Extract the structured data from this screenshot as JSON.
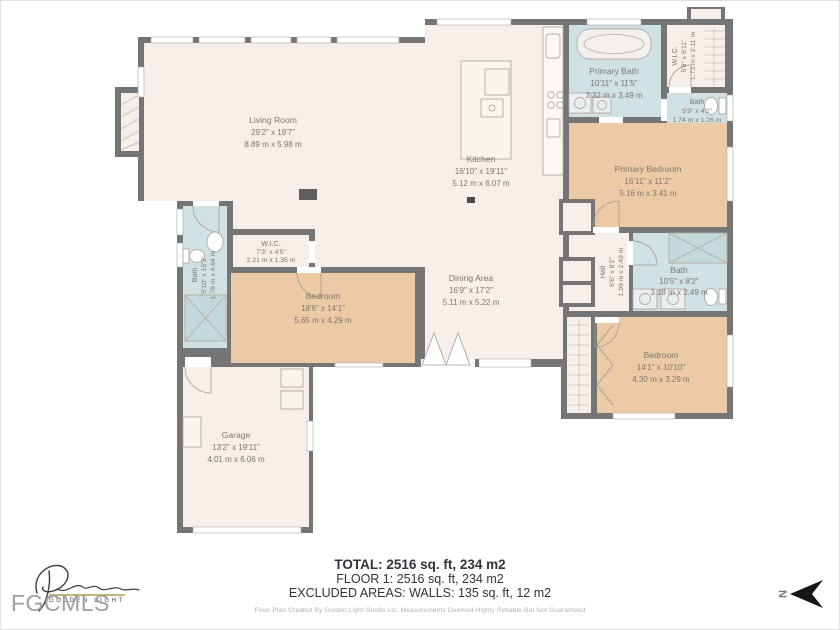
{
  "plan": {
    "rooms": {
      "living_room": {
        "name": "Living Room",
        "ft": "29'2\" x 19'7\"",
        "m": "8.89 m x 5.98 m"
      },
      "kitchen": {
        "name": "Kitchen",
        "ft": "16'10\" x 19'11\"",
        "m": "5.12 m x 6.07 m"
      },
      "primary_bath": {
        "name": "Primary Bath",
        "ft": "10'11\" x 11'5\"",
        "m": "3.32 m x 3.49 m"
      },
      "wic_top": {
        "name": "W.I.C.",
        "ft": "5'8\" x 6'11\"",
        "m": "1.73 m x 2.11 m"
      },
      "bath_top": {
        "name": "Bath",
        "ft": "5'9\" x 4'2\"",
        "m": "1.74 m x 1.26 m"
      },
      "primary_bedroom": {
        "name": "Primary Bedroom",
        "ft": "16'11\" x 11'2\"",
        "m": "5.16 m x 3.41 m"
      },
      "bath_left": {
        "name": "Bath",
        "ft": "5'10\" x 15'3\"",
        "m": "1.78 m x 4.64 m"
      },
      "wic_center": {
        "name": "W.I.C.",
        "ft": "7'3\" x 4'5\"",
        "m": "2.21 m x 1.35 m"
      },
      "bedroom_center": {
        "name": "Bedroom",
        "ft": "18'6\" x 14'1\"",
        "m": "5.65 m x 4.29 m"
      },
      "dining": {
        "name": "Dining Area",
        "ft": "16'9\" x 17'2\"",
        "m": "5.11 m x 5.22 m"
      },
      "hall": {
        "name": "Hall",
        "ft": "6'6\" x 8'2\"",
        "m": "1.99 m x 2.49 m"
      },
      "bath_right": {
        "name": "Bath",
        "ft": "10'5\" x 8'2\"",
        "m": "3.18 m x 2.49 m"
      },
      "bedroom_right": {
        "name": "Bedroom",
        "ft": "14'1\" x 10'10\"",
        "m": "4.30 m x 3.29 m"
      },
      "garage": {
        "name": "Garage",
        "ft": "13'2\" x 19'11\"",
        "m": "4.01 m x 6.06 m"
      }
    },
    "colors": {
      "room": "#f6efe9",
      "bedroom": "#eccaa5",
      "bath": "#cfe1e3",
      "wall": "#757575",
      "gold": "#c9b478"
    }
  },
  "summary": {
    "total": "TOTAL: 2516 sq. ft, 234 m2",
    "floor1": "FLOOR 1: 2516 sq. ft, 234 m2",
    "excluded": "EXCLUDED AREAS: WALLS: 135 sq. ft, 12 m2"
  },
  "footer": {
    "disclaimer": "Floor Plan Created By Golden Light Studio Llc. Measurements Deemed Highly Reliable But Not Guaranteed"
  },
  "logo": {
    "brand": "GOLDEN LIGHT",
    "watermark": "FGCMLS"
  },
  "compass": {
    "label": "N"
  }
}
